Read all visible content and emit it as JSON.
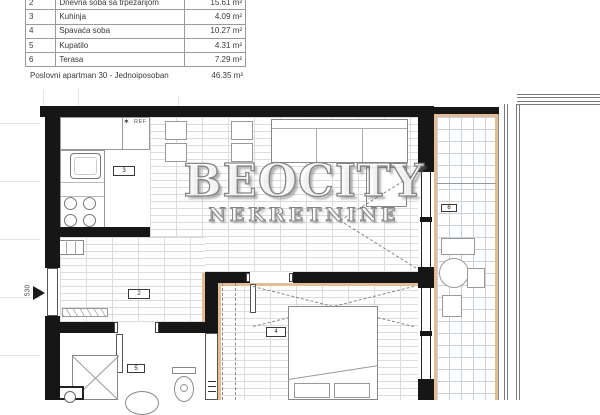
{
  "table": {
    "rows": [
      {
        "num": "2",
        "name": "Dnevna soba sa trpezarijom",
        "area": "15.61 m²"
      },
      {
        "num": "3",
        "name": "Kuhinja",
        "area": "4.09 m²"
      },
      {
        "num": "4",
        "name": "Spavaća soba",
        "area": "10.27 m²"
      },
      {
        "num": "5",
        "name": "Kupatilo",
        "area": "4.31 m²"
      },
      {
        "num": "6",
        "name": "Terasa",
        "area": "7.29 m²"
      }
    ],
    "footer": {
      "label": "Poslovni apartman 30 - Jednoiposoban",
      "area": "46.35 m²"
    }
  },
  "watermark": {
    "brand": "BEOCITY",
    "subtitle": "NEKRETNINE"
  },
  "plan": {
    "labels": {
      "fridge": "REF",
      "star": "✶",
      "entry_dim": "530",
      "living": "2",
      "kitchen": "3",
      "bedroom": "4",
      "bathroom": "5",
      "terrace": "6"
    },
    "colors": {
      "wall": "#161616",
      "terrace_border": "#e4bd94",
      "terrace_grid": "#c9d2d9",
      "floor_joint_line": "#dcdcdc"
    }
  }
}
